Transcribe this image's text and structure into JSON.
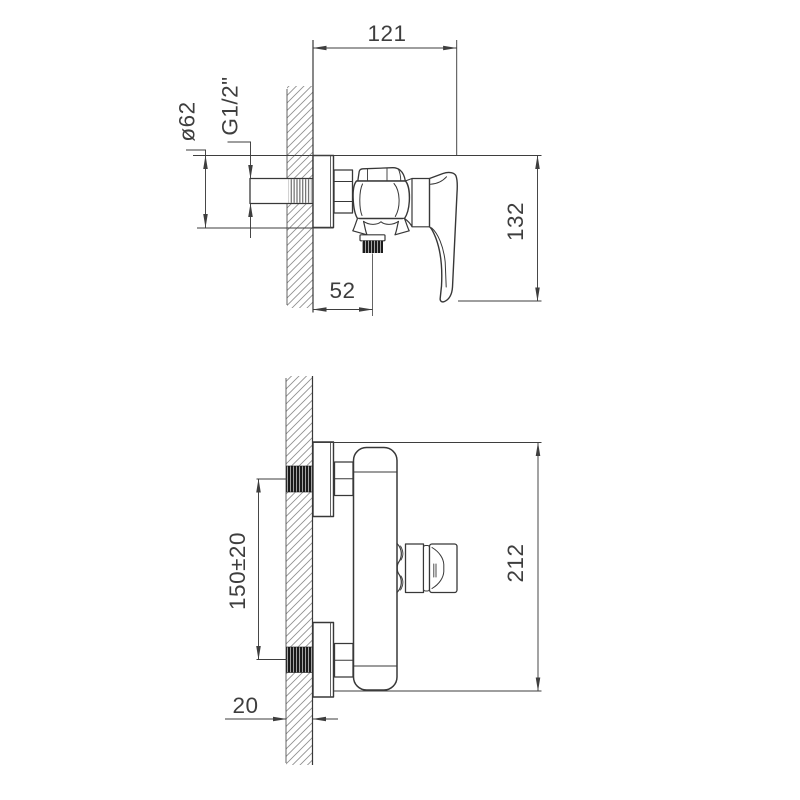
{
  "colors": {
    "background": "#ffffff",
    "line": "#383838",
    "dimension_line": "#3e3e3e",
    "hatch": "#8f8f8f",
    "thread_dark": "#1b1b1b"
  },
  "views": {
    "side_view": {
      "description": "wall-mounted shower mixer, side view",
      "dimensions": {
        "width": "121",
        "escutcheon_diameter": "ø62",
        "thread_size": "G1/2\"",
        "body_height": "132",
        "outlet_offset": "52"
      }
    },
    "front_view": {
      "description": "wall-mounted shower mixer, front view",
      "dimensions": {
        "inlet_spacing": "150±20",
        "overall_height": "212",
        "wall_thickness": "20"
      }
    }
  }
}
